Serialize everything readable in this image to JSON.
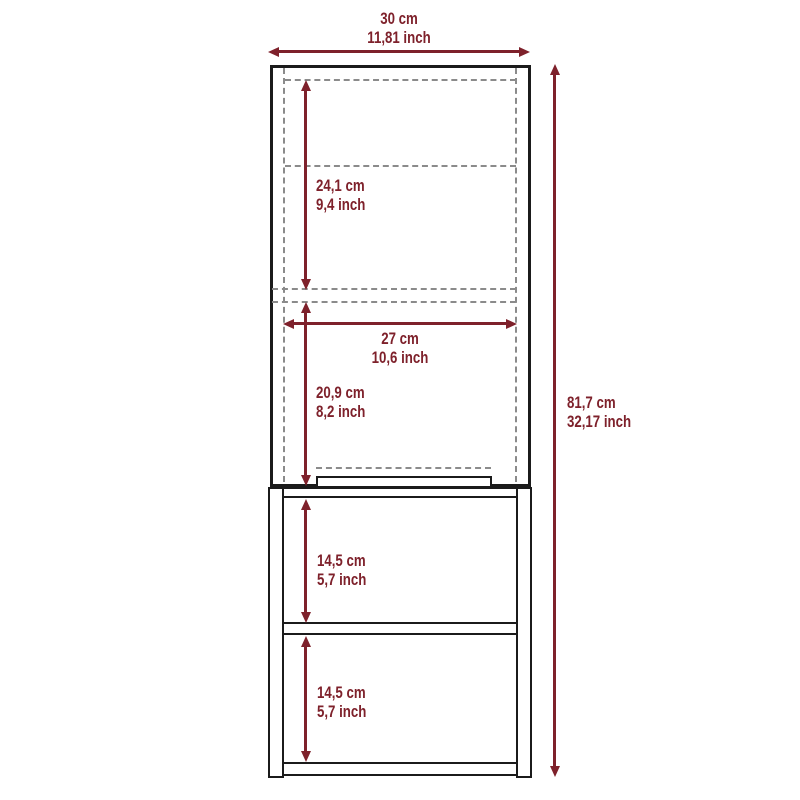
{
  "figure": {
    "title": "cabinet-dimension-diagram",
    "colors": {
      "dimension_accent": "#7E212B",
      "outline_ink": "#1b1b1b",
      "hidden_edge_gray": "#8b8b8b",
      "background": "#ffffff"
    }
  },
  "dims": {
    "top_width": {
      "cm": "30 cm",
      "inch": "11,81 inch"
    },
    "right_height": {
      "cm": "81,7 cm",
      "inch": "32,17 inch"
    },
    "upper_inner_height": {
      "cm": "24,1 cm",
      "inch": "9,4 inch"
    },
    "middle_inner_width": {
      "cm": "27 cm",
      "inch": "10,6 inch"
    },
    "middle_inner_height": {
      "cm": "20,9 cm",
      "inch": "8,2 inch"
    },
    "lower_shelf_1_height": {
      "cm": "14,5 cm",
      "inch": "5,7 inch"
    },
    "lower_shelf_2_height": {
      "cm": "14,5 cm",
      "inch": "5,7 inch"
    }
  }
}
